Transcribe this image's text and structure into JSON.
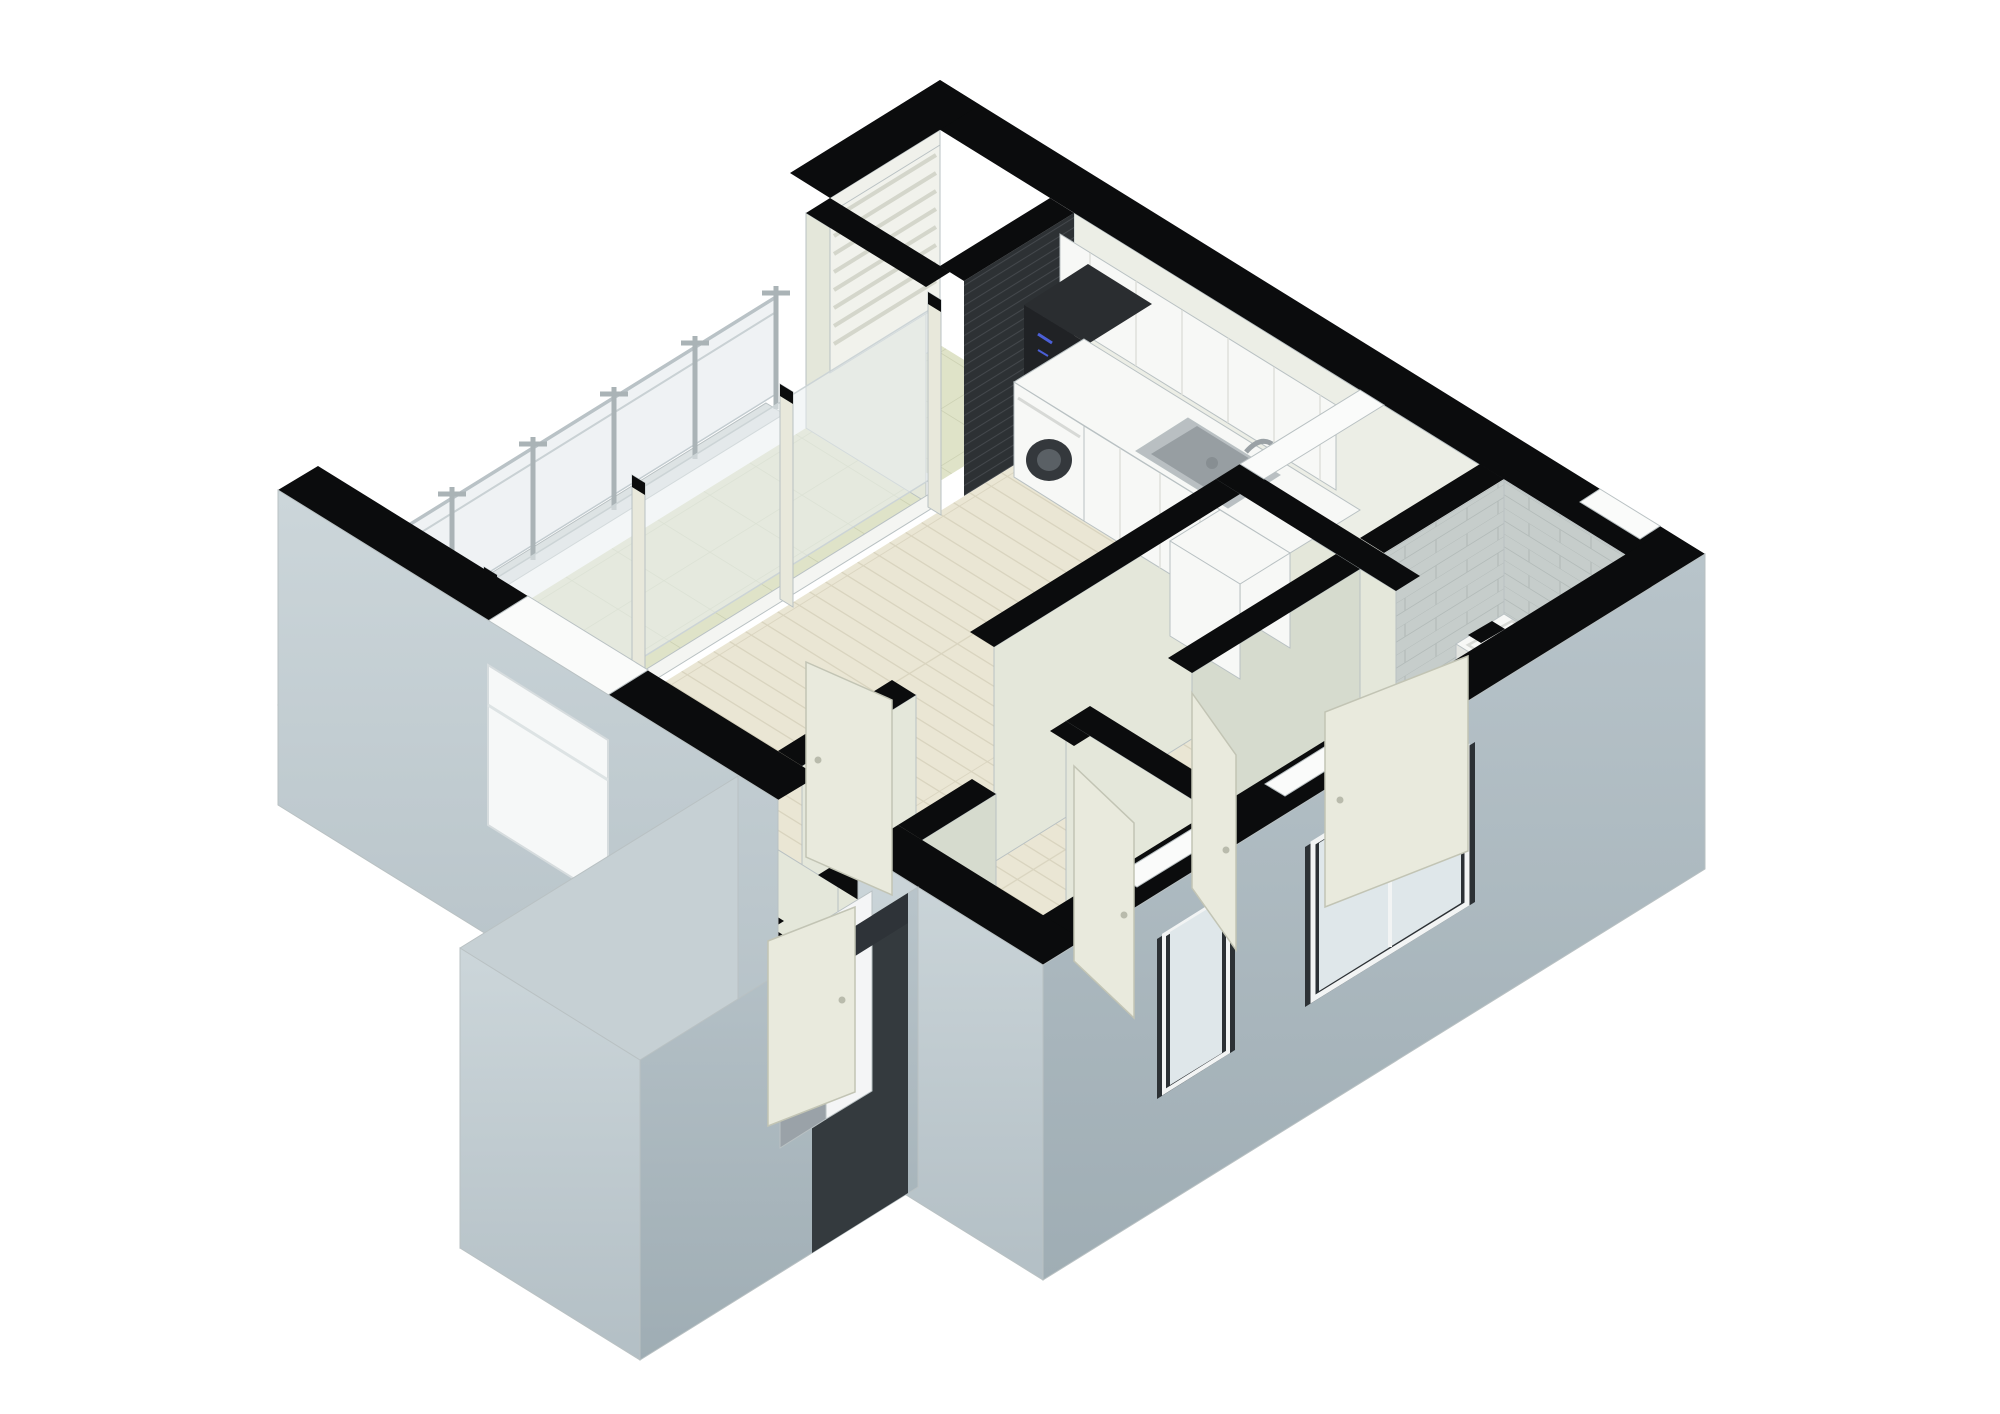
{
  "scene": {
    "type": "3d-axonometric-floor-plan-render",
    "description": "Cutaway 3D floor plan of a one/two-bedroom apartment viewed from above at 45 degrees, walls cut and capped black, white background, no text labels",
    "rooms": [
      {
        "name": "balcony",
        "floor": "pale-green-tile",
        "feature": "glass-balustrade"
      },
      {
        "name": "living-dining",
        "floor": "light-wood-plank"
      },
      {
        "name": "kitchen",
        "floor": "light-wood-plank",
        "feature": "L-shaped-white-counter"
      },
      {
        "name": "bathroom-main",
        "floor": "gray-tile-diagonal",
        "fixtures": [
          "bathtub",
          "toilet",
          "shelf"
        ]
      },
      {
        "name": "bedroom-1",
        "floor": "light-wood-plank",
        "feature": "window-southeast"
      },
      {
        "name": "bedroom-2",
        "floor": "light-wood-plank",
        "feature": "window-southeast"
      },
      {
        "name": "hallway-foyer",
        "floor": "light-wood-plank"
      },
      {
        "name": "entry-vestibule-wing",
        "floor": "gray-tile",
        "fixtures": [
          "shower-drain",
          "towel-bar"
        ]
      },
      {
        "name": "service-shaft",
        "appearance": "dark-void"
      },
      {
        "name": "duct-pocket",
        "appearance": "dark-void"
      }
    ],
    "fixtures": [
      "washing-machine",
      "built-in-oven",
      "kitchen-sink",
      "upper-cabinets",
      "bathtub",
      "toilet",
      "shower-drain",
      "entrance-sliding-door",
      "interior-doors-open"
    ]
  },
  "colors": {
    "background": "#ffffff",
    "band": "#0b0c0d",
    "band_white": "#fafbfa",
    "edge": "#b9c1c3",
    "seam": "#dddfd9",
    "wood_floor": "#eae6d4",
    "wood_line": "#d9d4bf",
    "balcony_tile": "#dfe3c8",
    "balcony_line": "#cbd0b2",
    "gray_tile": "#a2acac",
    "gray_tile_line": "#c6cecd",
    "wall_cream": "#e4e7da",
    "wall_cream_dark": "#d6dbce",
    "wall_tile": "#c6cdcb",
    "wall_tile_line": "#b3bbb9",
    "ext_sw_light": "#ccd6da",
    "ext_sw_dark": "#b3bfc5",
    "ext_se_light": "#b8c4ca",
    "ext_se_dark": "#9fadb4",
    "shaft_top": "#8d979d",
    "shaft_bottom": "#17191b",
    "pocket_top": "#a7b2b8",
    "pocket_bottom": "#1a1c1f",
    "fixture_white": "#f7f8f6",
    "fixture_shadow": "#e2e4e0",
    "steel": "#b9bfc2",
    "steel_dark": "#979ea2",
    "appliance_dark": "#202225",
    "appliance_top": "#2a2d30",
    "appliance_blue": "#4b5fd6",
    "washer_door": "#34383c",
    "door_leaf": "#e9eadd",
    "door_edge": "#c2c4b4",
    "glass": "#dfe7ea",
    "glass_light": "#eef2f3",
    "post": "#aab3b6",
    "window_recess": "#2c3135",
    "entrance_gray": "#9aa2a8",
    "entrance_band": "#2e3338"
  }
}
